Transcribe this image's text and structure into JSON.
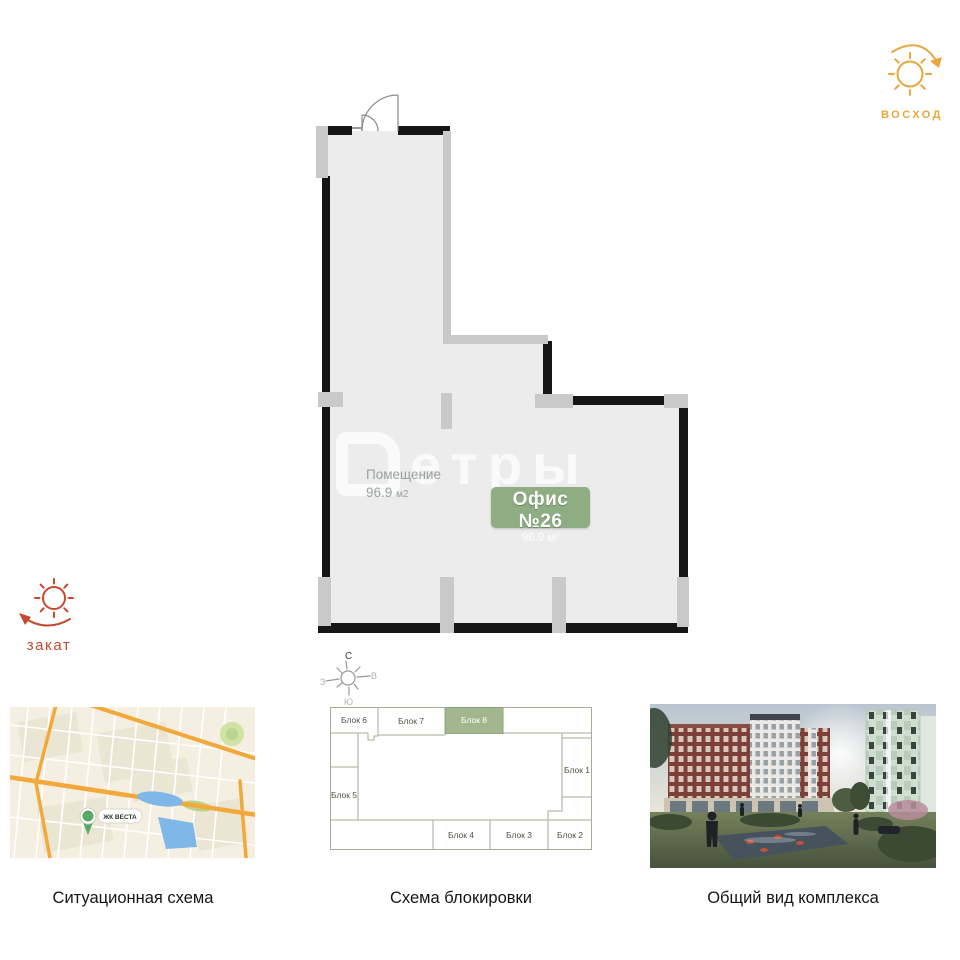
{
  "icons": {
    "sunrise": {
      "label": "ВОСХОД",
      "color": "#E8A63C"
    },
    "sunset": {
      "label": "закат",
      "color": "#C4492F"
    }
  },
  "floor_plan": {
    "room": {
      "name": "Помещение",
      "area": "96.9",
      "area_unit": "м2"
    },
    "badge": {
      "title": "Офис №26",
      "area": "96.9 м²",
      "bg": "#8FAD82"
    },
    "watermark": "етры",
    "colors": {
      "floor": "#ECECEC",
      "wall": "#161616",
      "light_wall": "#C9C9C9"
    }
  },
  "panels": {
    "situation": {
      "caption": "Ситуационная схема",
      "pin_label": "ЖК ВЕСТА",
      "colors": {
        "road": "#F2A93C",
        "water": "#7FB7E8",
        "bg": "#F5EFE1"
      }
    },
    "blocking": {
      "caption": "Схема блокировки",
      "compass": {
        "north": "С",
        "south": "Ю",
        "east": "В",
        "west": "З"
      },
      "highlight_color": "#A3B78F",
      "blocks": [
        {
          "label": "Блок 1",
          "highlighted": false
        },
        {
          "label": "Блок 2",
          "highlighted": false
        },
        {
          "label": "Блок 3",
          "highlighted": false
        },
        {
          "label": "Блок 4",
          "highlighted": false
        },
        {
          "label": "Блок 5",
          "highlighted": false
        },
        {
          "label": "Блок 6",
          "highlighted": false
        },
        {
          "label": "Блок 7",
          "highlighted": false
        },
        {
          "label": "Блок 8",
          "highlighted": true
        }
      ]
    },
    "overview": {
      "caption": "Общий вид комплекса"
    }
  }
}
